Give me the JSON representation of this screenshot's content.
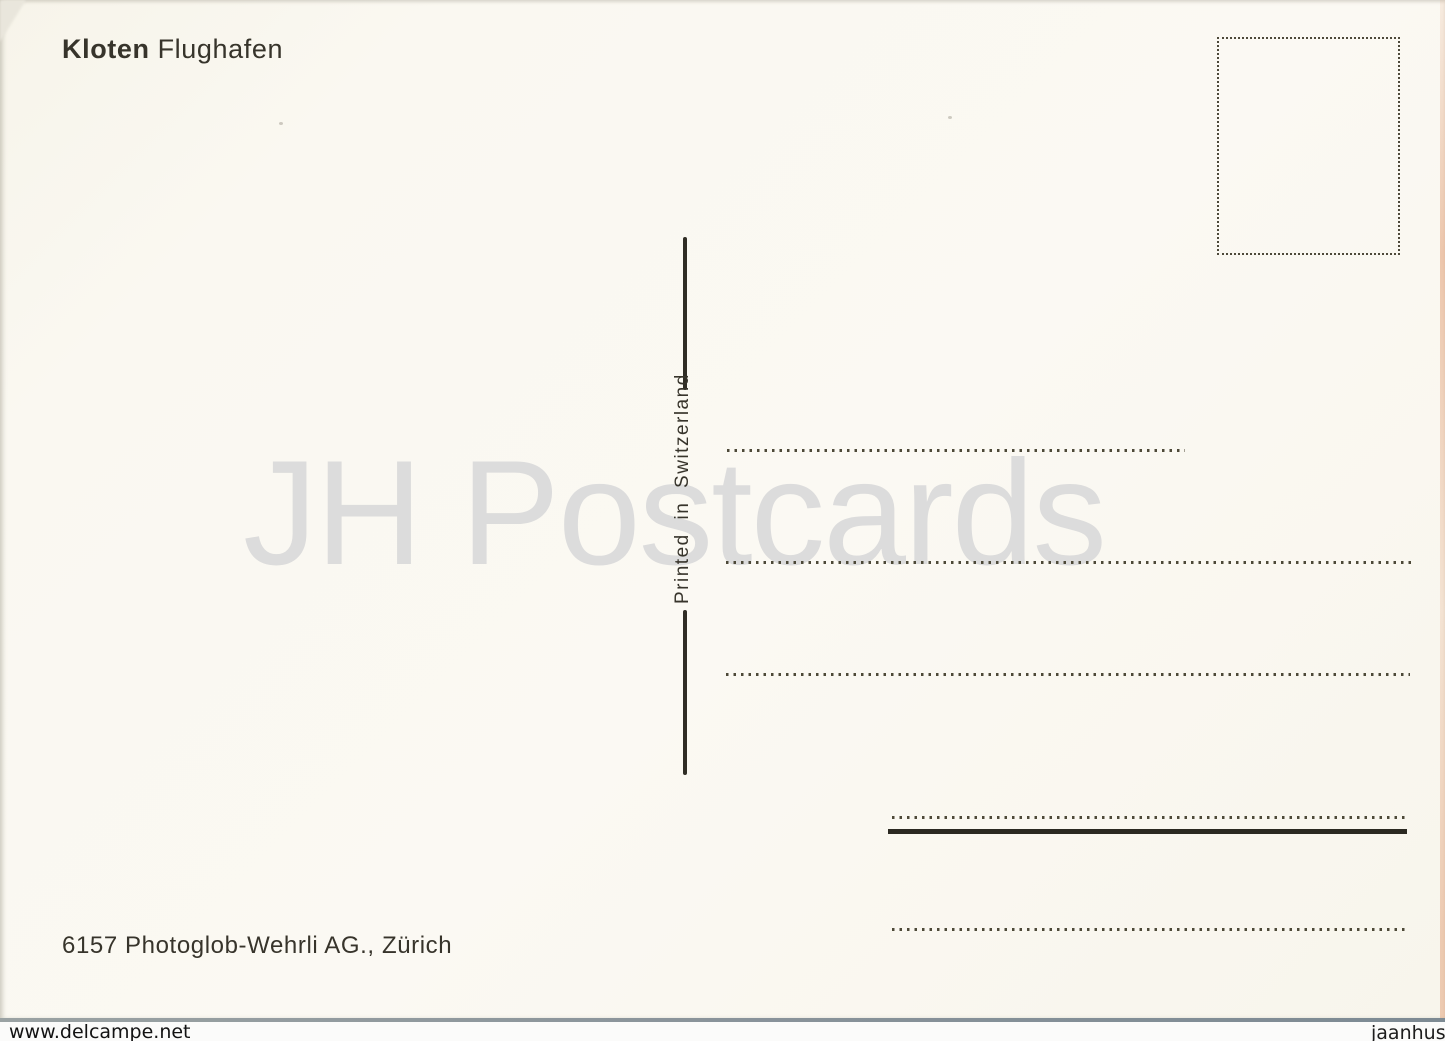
{
  "postcard": {
    "title": {
      "bold": "Kloten",
      "regular": "Flughafen"
    },
    "printed_in": "Printed in Switzerland",
    "publisher": "6157 Photoglob-Wehrli AG., Zürich",
    "stamp_box": "dotted-square-stamp-area",
    "address_lines_count": 5
  },
  "overlay": {
    "big_watermark": "JH Postcards",
    "seller_watermark_left": "www.delcampe.net",
    "seller_watermark_right": "jaanhus"
  },
  "colors": {
    "card_background": "#faf8f1",
    "ink": "#37342b",
    "watermark_gray": "#dcdcdc",
    "bottom_edge_line": "#8c969b",
    "right_edge_tint": "#e09669"
  }
}
